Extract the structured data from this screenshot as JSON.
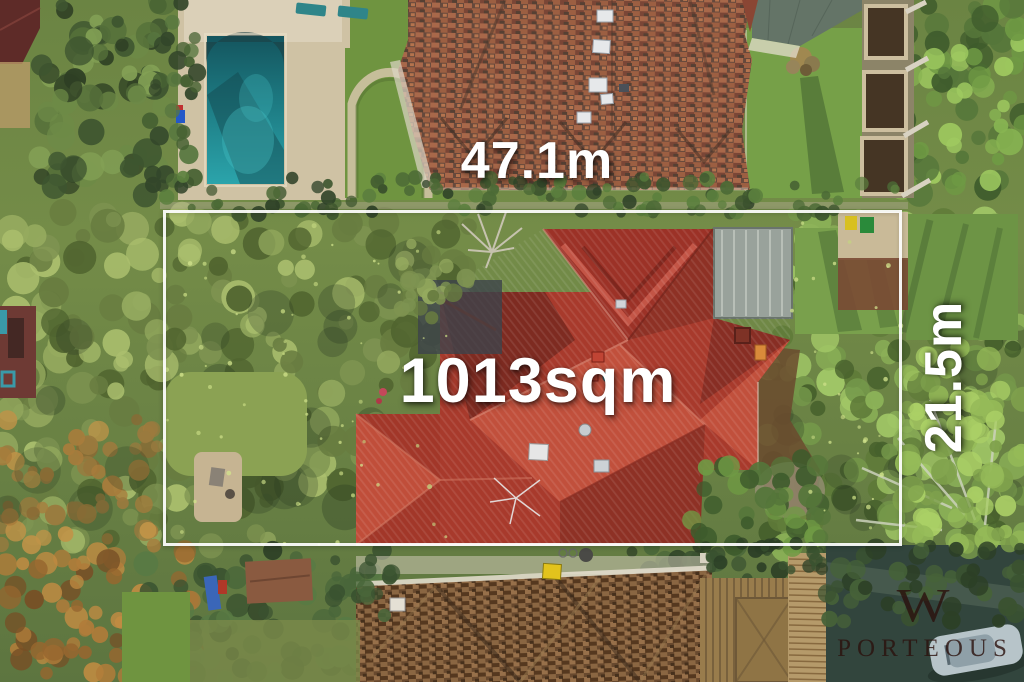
{
  "annotations": {
    "frontage": "47.1m",
    "area": "1013sqm",
    "side": "21.5m"
  },
  "watermark": {
    "initial": "W",
    "name": "PORTEOUS"
  },
  "colors": {
    "label_text": "#ffffff",
    "boundary_line": "#ffffff",
    "watermark": "#2b110d",
    "main_roof_red": "#a83a2c",
    "pool_water": "#2ba4ab"
  }
}
